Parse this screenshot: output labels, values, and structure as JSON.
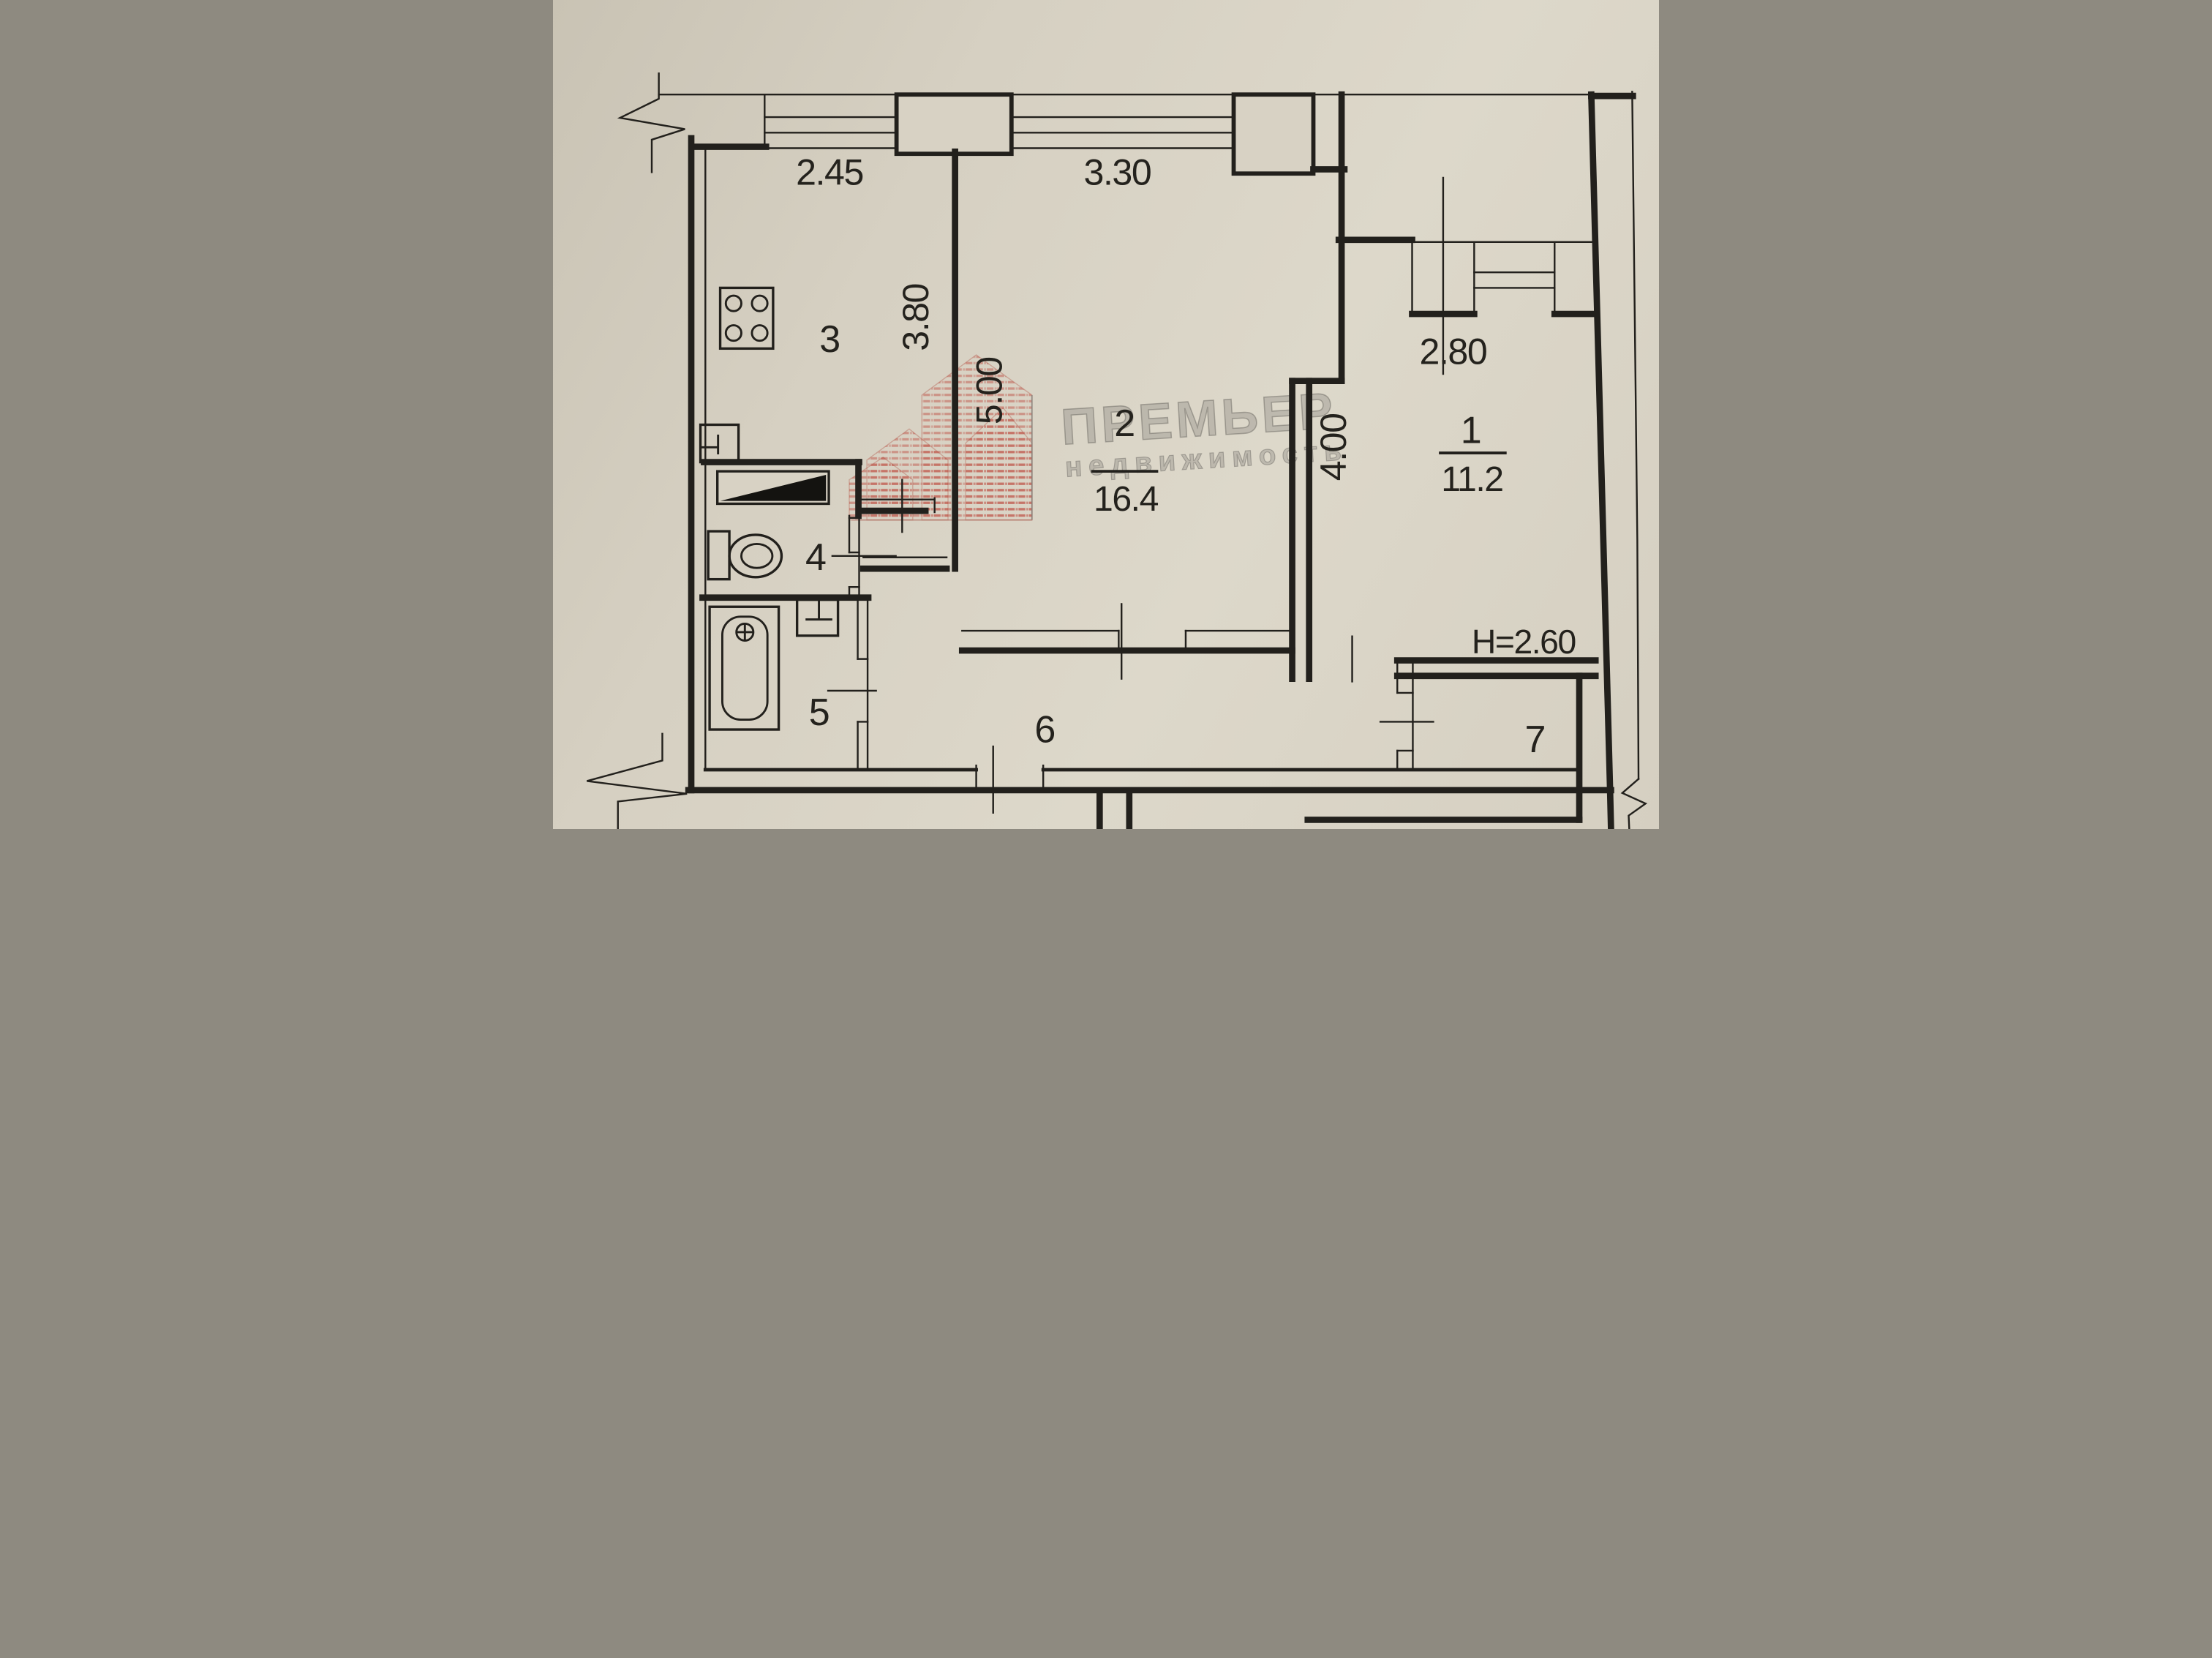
{
  "plan": {
    "watermark": {
      "brand": "ПРЕМЬЕР",
      "tagline": "недвижимость"
    },
    "dims": {
      "kitchen_window": "2.45",
      "room2_window": "3.30",
      "room1_window": "2.80",
      "kitchen_depth": "3.80",
      "room2_depth": "5.00",
      "room1_depth": "4.00",
      "ceiling_height": "H=2.60"
    },
    "rooms": {
      "living1": {
        "number": "1",
        "area": "11.2"
      },
      "living2": {
        "number": "2",
        "area": "16.4"
      },
      "kitchen": {
        "number": "3"
      },
      "wc": {
        "number": "4"
      },
      "bath": {
        "number": "5"
      },
      "hall": {
        "number": "6"
      },
      "storage": {
        "number": "7"
      }
    },
    "colors": {
      "paper": "#d7d1c3",
      "ink": "#22201c",
      "logo_red": "#c05a4d",
      "watermark_gray": "#7a7872"
    }
  }
}
